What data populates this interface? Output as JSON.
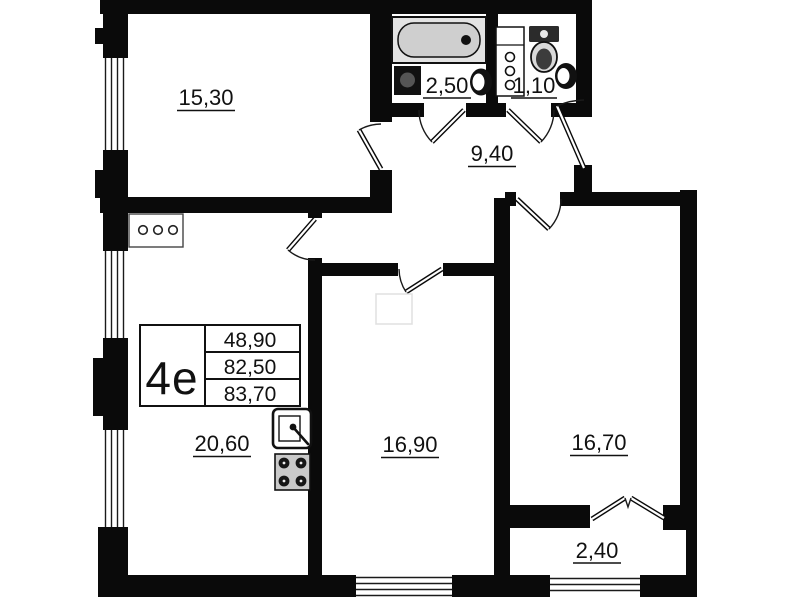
{
  "unit_info": {
    "type_label": "4e",
    "areas": [
      "48,90",
      "82,50",
      "83,70"
    ]
  },
  "room_areas": {
    "top_left_room": "15,30",
    "bathroom": "2,50",
    "wc": "1,10",
    "hallway": "9,40",
    "kitchen_living": "20,60",
    "middle_room": "16,90",
    "right_room": "16,70",
    "balcony": "2,40"
  },
  "icons": [
    "bathtub-icon",
    "washbasin-icon",
    "sink-icon",
    "toilet-icon",
    "pipe-shaft-icon",
    "vent-holes-icon",
    "kitchen-sink-icon",
    "stove-icon"
  ],
  "colors": {
    "wall": "#0a0a0a",
    "background": "#ffffff",
    "fixture_gray": "#cfcfcf",
    "text": "#111111"
  }
}
